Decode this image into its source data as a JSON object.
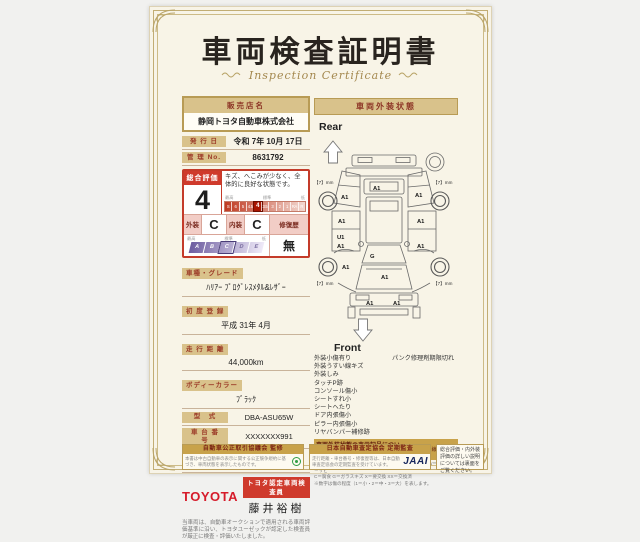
{
  "colors": {
    "paper": "#f8f4e7",
    "gold": "#c8a24a",
    "tan_chip": "#d9c28b",
    "dark_red": "#8d3526",
    "red": "#cf3a2c",
    "toyota_red": "#d61b2a"
  },
  "title": {
    "main": "車両検査証明書",
    "sub": "Inspection Certificate"
  },
  "dealer": {
    "label": "販売店名",
    "name": "静岡トヨタ自動車株式会社"
  },
  "issue": {
    "label": "発 行 日",
    "value": "令和 7年 10月 17日"
  },
  "control": {
    "label": "管 理 No.",
    "value": "8631792"
  },
  "evaluation": {
    "overall_label": "総合評価",
    "overall_grade": "4",
    "comment": "キズ、へこみが少なく、全体的に良好な状態です。",
    "scale_high": "最高",
    "scale_mid": "標準",
    "scale_low": "低",
    "grade_scale": [
      "S",
      "6",
      "5",
      "4.5",
      "4",
      "3.5",
      "3",
      "2",
      "1",
      "RA",
      "R"
    ],
    "exterior_label": "外装",
    "exterior_grade": "C",
    "interior_label": "内装",
    "interior_grade": "C",
    "repair_label": "修復歴",
    "repair_value": "無",
    "letter_scale": [
      "A",
      "B",
      "C",
      "D",
      "E"
    ]
  },
  "details": [
    {
      "label": "車種・グレード",
      "value": "ﾊﾘｱｰ ﾌﾟﾛｸﾞﾚｽﾒﾀﾙ&ﾚｻﾞｰ"
    },
    {
      "label": "初 度 登 録",
      "value": "平成 31年 4月"
    },
    {
      "label": "走 行 距 離",
      "value": "44,000km"
    },
    {
      "label": "ボディーカラー",
      "value": "ﾌﾞﾗｯｸ"
    },
    {
      "label": "型　式",
      "value": "DBA-ASU65W"
    },
    {
      "label": "車 台 番 号",
      "value": "XXXXXXX991"
    },
    {
      "label": "エ ン ジ ン",
      "value": "ガソリン"
    }
  ],
  "inspector": {
    "brand": "TOYOTA",
    "badge": "トヨタ認定車両検査員",
    "name": "藤井裕樹",
    "note": "当車両は、自動車オークションで適用される車両評価基準に沿い、トヨタユーゼックが認定した検査員が厳正に検査・評価いたしました。"
  },
  "footer": {
    "box1": {
      "title": "自動車公正取引協議会 監修",
      "text": "本書は中古自動車の表示に関する公正競争規約に基づき、車両状態を表示したものです。"
    },
    "box2": {
      "title": "日本自動車査定協会 定期監査",
      "text": "走行距離・車台番号・修復歴等は、日本自動車査定協会の定期監査を受けています。",
      "logo": "JAAI"
    },
    "box3": {
      "text": "総合評価・内外装評価の詳しい説明については裏面をご覧ください。"
    }
  },
  "exterior": {
    "header": "車両外装状態",
    "rear_label": "Rear",
    "front_label": "Front",
    "tires": {
      "rl": "【7】mm",
      "rr": "【7】mm",
      "fl": "【7】mm",
      "fr": "【7】mm"
    },
    "marks": [
      "A1",
      "A1",
      "A1",
      "A1",
      "A1",
      "U1",
      "A1",
      "A1",
      "G",
      "A1",
      "A1",
      "A1",
      "A1"
    ],
    "conditions_left": [
      "外装小傷有り",
      "外装うすい線キズ",
      "外装しみ",
      "タッチP跡",
      "コンソール傷小",
      "シートすれ小",
      "シートへたり",
      "ドア内張傷小",
      "ピラー内張傷小",
      "リヤバンパー補修跡"
    ],
    "conditions_right": [
      "パンク修理剤期限切れ"
    ],
    "legend": {
      "title": "車両外装状態の表示記号について",
      "example": "（例：A1＝線キズ 小）",
      "line1": "A＝線キズ U＝へこみ B＝キズを伴うへこみ P＝塗装跡 W＝補修跡 S＝サビ",
      "line2": "C＝腐食 G＝ガラスキズ X＝要交換 XX＝交換済",
      "line3": "※数字は傷の程度（1＝小・2＝中・3＝大）を表します。"
    }
  }
}
